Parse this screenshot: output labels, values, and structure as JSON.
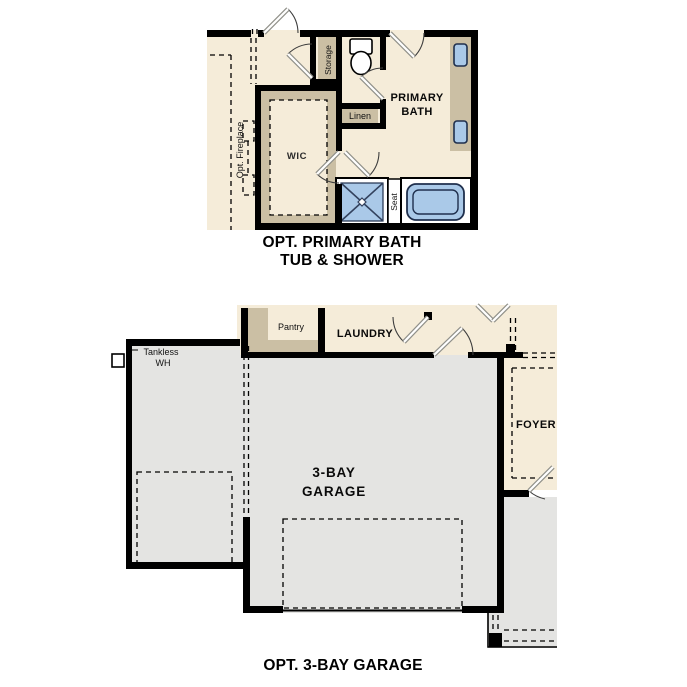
{
  "sheet": {
    "background_color": "#ffffff"
  },
  "colors": {
    "room_floor_cream": "#f5ecd9",
    "cabinet_tan": "#cbbfa4",
    "garage_gray": "#e4e4e2",
    "fixture_blue": "#aac9e8",
    "wall_black": "#000000"
  },
  "icons": {
    "toilet": "toilet-icon",
    "sink": "sink-icon",
    "shower": "shower-icon",
    "tub": "tub-icon",
    "door_swing": "door-swing-icon",
    "water_heater": "water-heater-icon",
    "fireplace": "fireplace-icon"
  },
  "primary_bath_plan": {
    "title_line1": "OPT. PRIMARY BATH",
    "title_line2": "TUB & SHOWER",
    "labels": {
      "storage": "Storage",
      "primary_line1": "PRIMARY",
      "primary_line2": "BATH",
      "linen": "Linen",
      "wic": "WIC",
      "opt_fireplace": "Opt. Fireplace",
      "seat": "Seat"
    }
  },
  "garage_plan": {
    "title": "OPT. 3-BAY GARAGE",
    "labels": {
      "tankless_line1": "Tankless",
      "tankless_line2": "WH",
      "pantry": "Pantry",
      "laundry": "LAUNDRY",
      "garage_line1": "3-BAY",
      "garage_line2": "GARAGE",
      "foyer": "FOYER"
    }
  }
}
